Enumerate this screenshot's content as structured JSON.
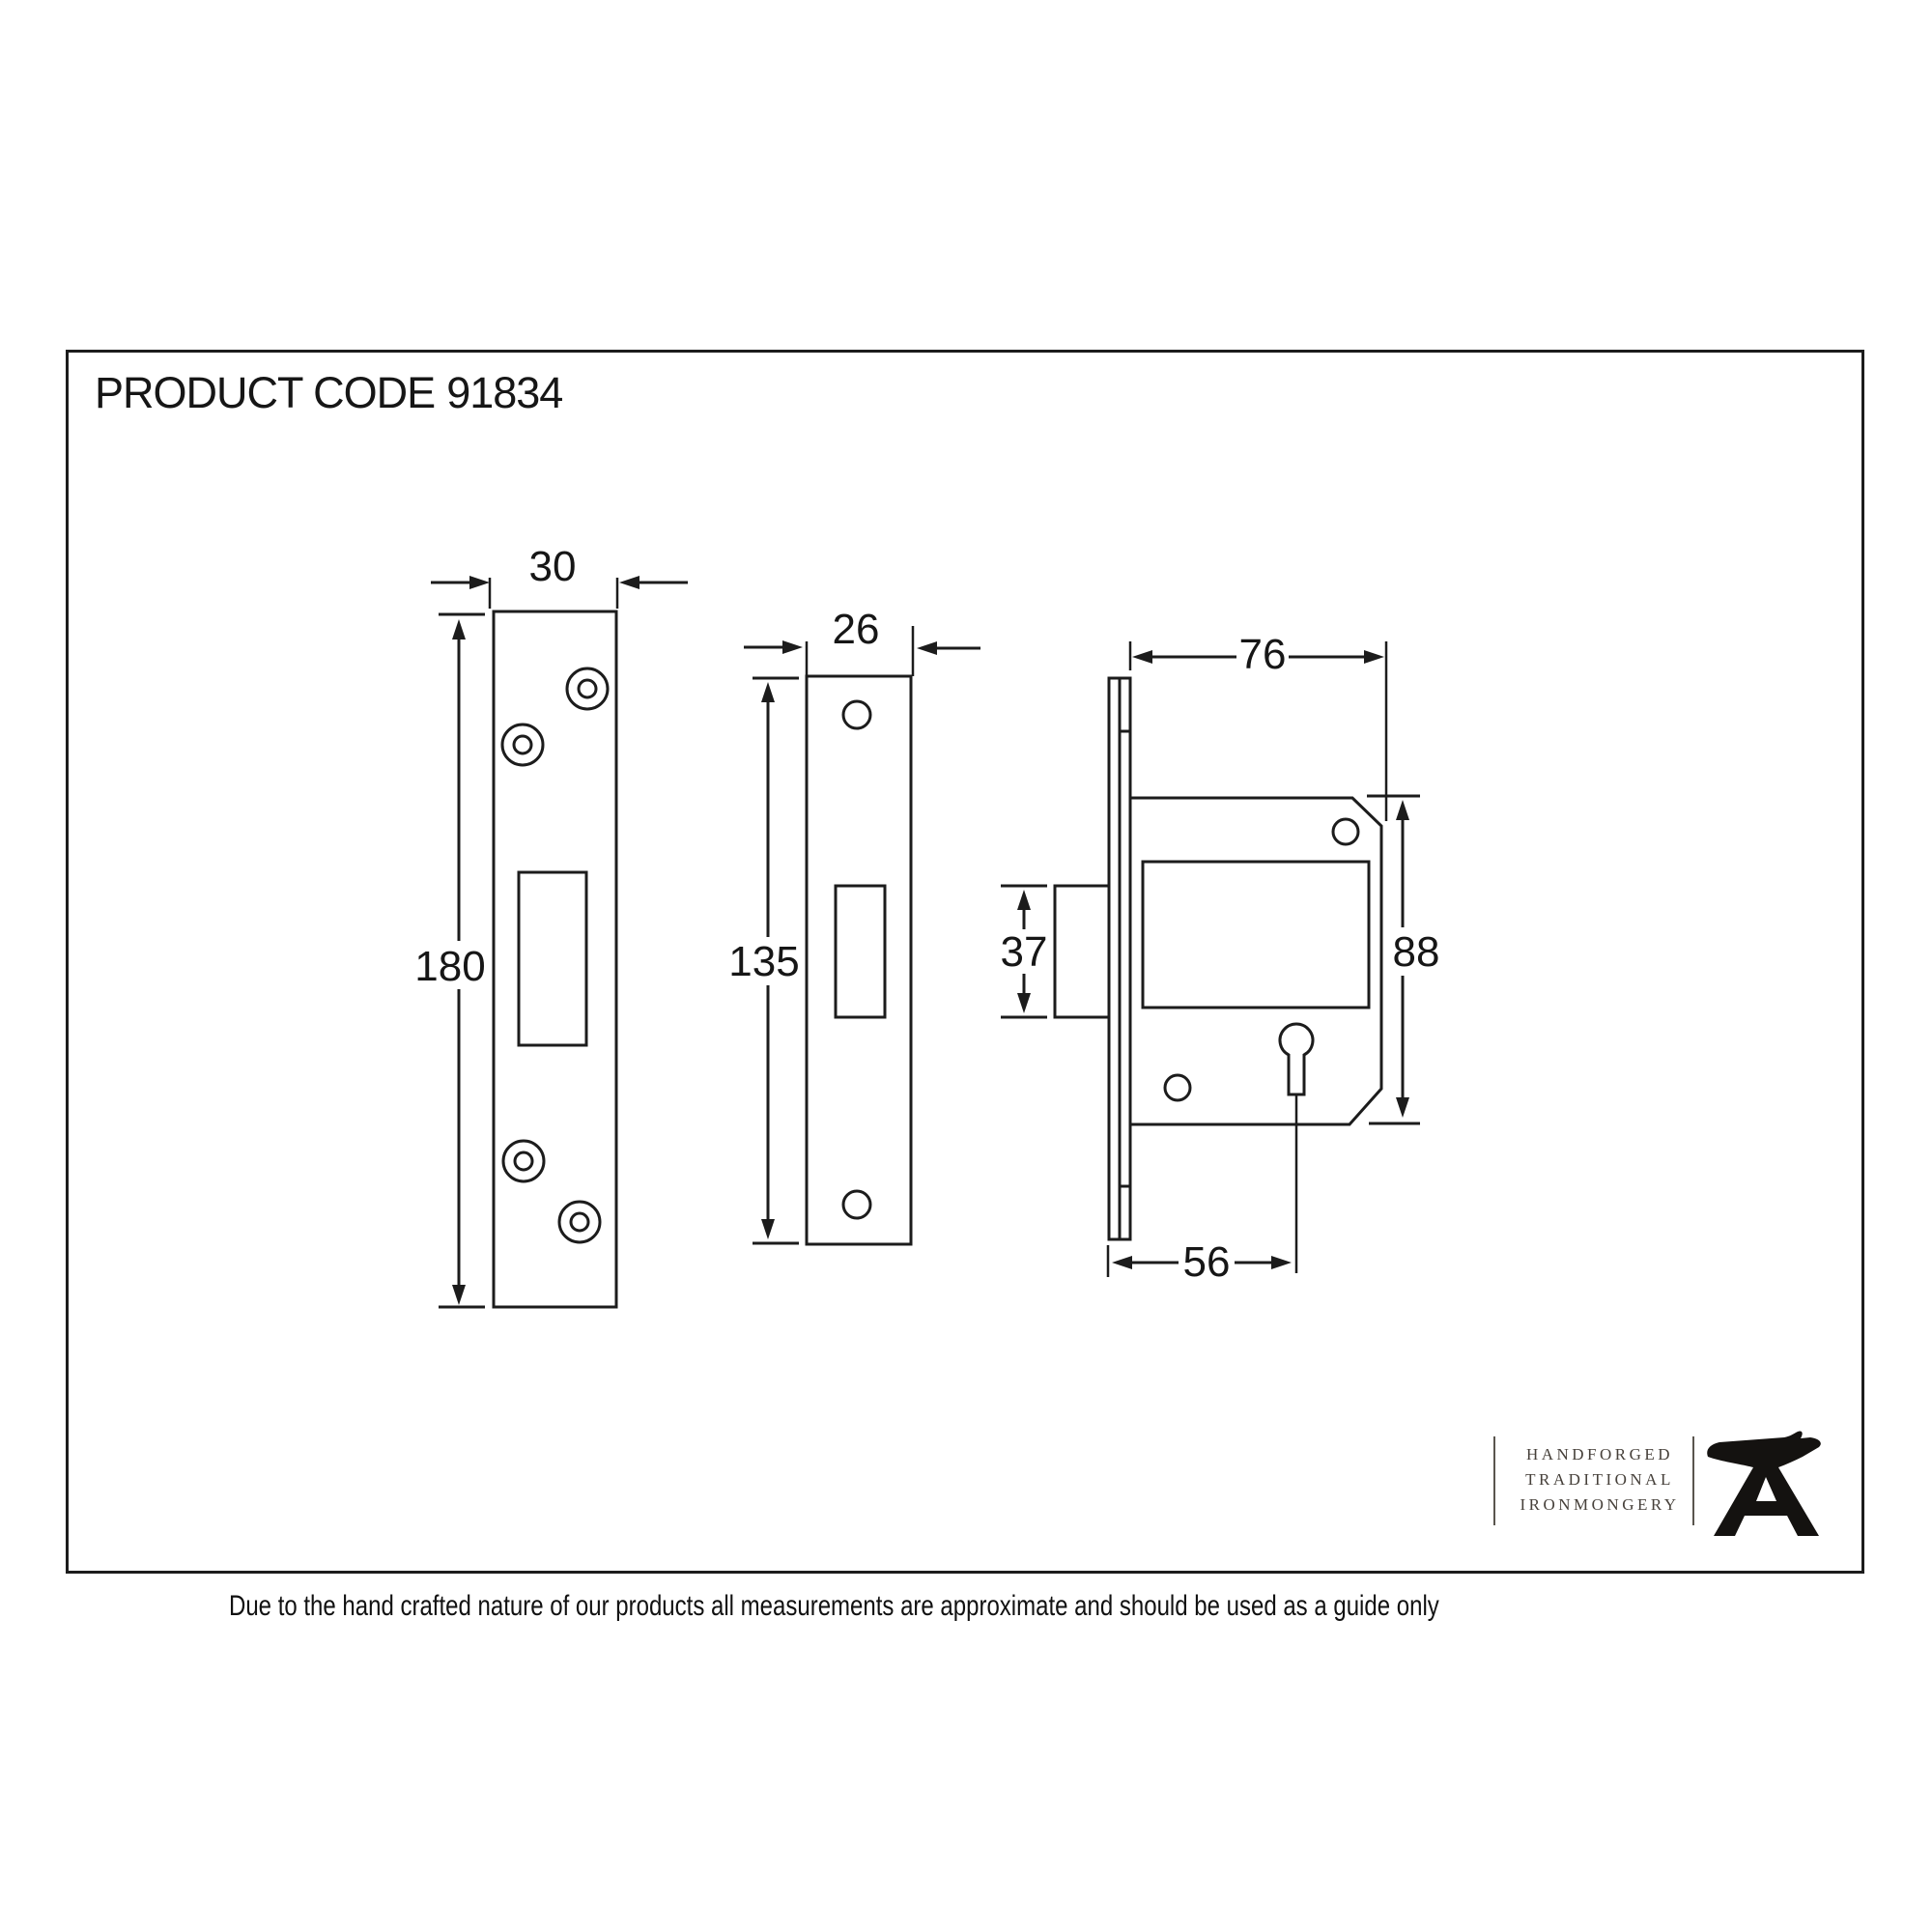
{
  "header": {
    "product_code_label": "PRODUCT CODE",
    "product_code_value": "91834"
  },
  "dimensions": {
    "forend_width": "30",
    "forend_height": "180",
    "strike_width": "26",
    "strike_height": "135",
    "case_depth": "76",
    "case_height": "88",
    "bolt_height": "37",
    "backset": "56"
  },
  "logo": {
    "line1": "HANDFORGED",
    "line2": "TRADITIONAL",
    "line3": "IRONMONGERY"
  },
  "footer": {
    "disclaimer": "Due to the hand crafted nature of our products all measurements are approximate and should be used as a guide only"
  },
  "colors": {
    "line": "#1c1c1c",
    "logo_text": "#46403a",
    "background": "#ffffff"
  }
}
